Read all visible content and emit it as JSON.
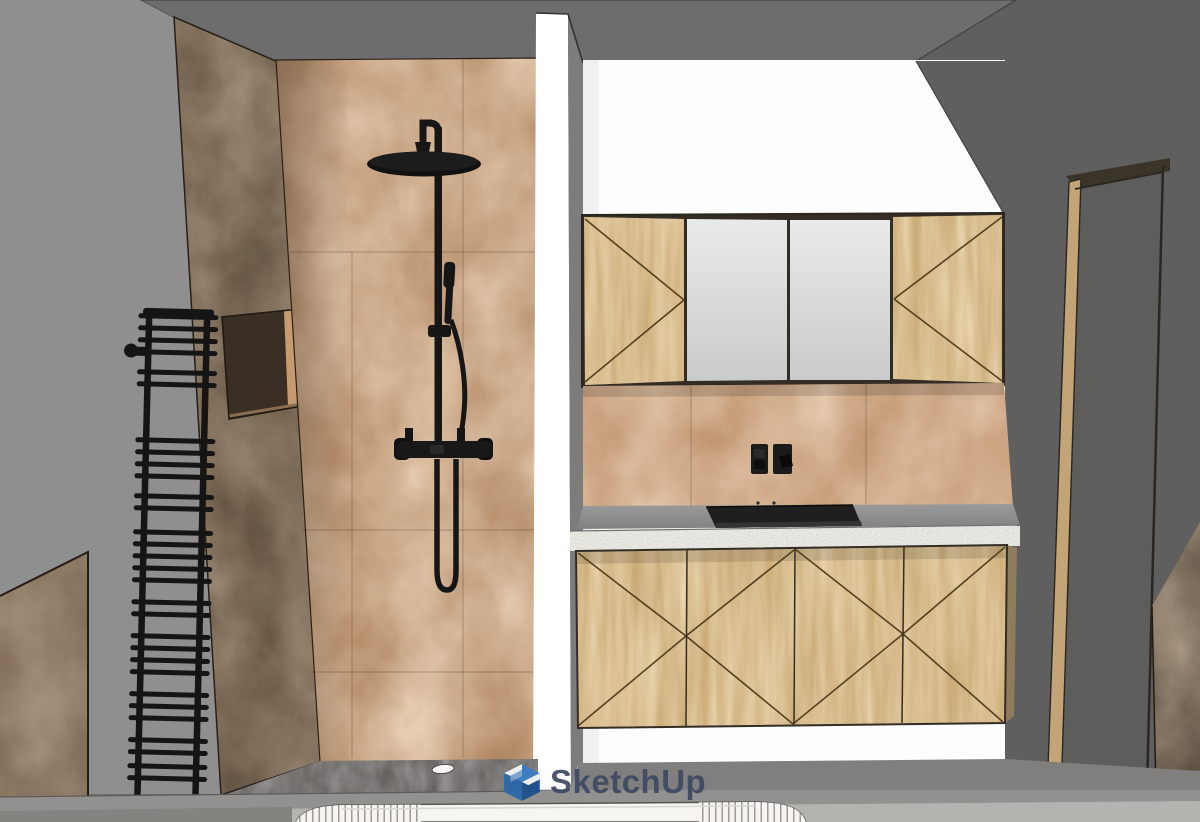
{
  "watermark": {
    "text": "SketchUp",
    "text_color": "#3e4a63",
    "logo_colors": {
      "top": "#3b7fc4",
      "left": "#2a67aa",
      "right": "#1c4e8b",
      "fold": "#ffffff"
    }
  },
  "viewport": {
    "kind": "sketchup-3d-model-view",
    "description": "Bathroom interior: tiled walk-in shower with black rain shower column and black ladder towel radiator on the left; white partition wall; wooden mirror cabinet and 4-door vanity with white-edged countertop, black sink and black double socket on the right; door frame on right wall; fluted freestanding bathtub rim at bottom edge",
    "objects": [
      {
        "name": "ceiling",
        "color": "#6d6d6d"
      },
      {
        "name": "left-wall",
        "color": "#8f8f8f"
      },
      {
        "name": "right-wall",
        "color": "#5f5f5f"
      },
      {
        "name": "white-back-wall",
        "color": "#fdfdfd"
      },
      {
        "name": "partition-wall",
        "face_color": "#ffffff",
        "side_color": "#7c7c7c"
      },
      {
        "name": "shower-side-wall",
        "color": "#51402e"
      },
      {
        "name": "shower-back-wall-tiles",
        "color": "#a87c57"
      },
      {
        "name": "shower-niche",
        "back_color": "#c59b6f"
      },
      {
        "name": "rain-shower-column",
        "color": "#161616"
      },
      {
        "name": "hand-shower-with-hose",
        "color": "#161616"
      },
      {
        "name": "thermostatic-valve",
        "color": "#181818"
      },
      {
        "name": "towel-radiator",
        "color": "#151515",
        "style": "ladder"
      },
      {
        "name": "half-wall-panel",
        "color": "#6d5642"
      },
      {
        "name": "mirror-cabinet",
        "wood_color": "#c6a46d",
        "mirror_color": "#d9dbda",
        "wood_doors": 2,
        "mirror_doors": 2
      },
      {
        "name": "backsplash-tiles",
        "color": "#b5835c"
      },
      {
        "name": "double-socket",
        "color": "#1b1b1b",
        "modules": 2
      },
      {
        "name": "countertop",
        "top_color": "#8f8f8f",
        "edge_color": "#f0efe9"
      },
      {
        "name": "sink",
        "color": "#1f1f1f"
      },
      {
        "name": "vanity-unit",
        "wood_color": "#c6a46d",
        "doors": 4
      },
      {
        "name": "door-frame",
        "jamb_color": "#c2a476",
        "frame_color": "#3b3429"
      },
      {
        "name": "open-door",
        "color": "#4a3e31"
      },
      {
        "name": "shower-floor",
        "color": "#53504d",
        "drain_color": "#f8f7f3"
      },
      {
        "name": "floor",
        "band_color": "#929190"
      },
      {
        "name": "bathtub",
        "color": "#f6f5f1",
        "style": "fluted-ribbed"
      }
    ]
  },
  "theme": {
    "colors": {
      "ceiling": "#6d6d6d",
      "wall-left": "#8f8f8f",
      "wall-right": "#5f5f5f",
      "wall-white": "#fdfdfd",
      "partition-face": "#ffffff",
      "partition-side": "#7c7c7c",
      "tile-base": "#a87c57",
      "tile-backsplash": "#b5835c",
      "dark-wall": "#51402e",
      "panel-brown": "#6d5642",
      "wood": "#c6a46d",
      "wood-line": "#54401f",
      "line-dark": "#2b2621",
      "counter-top": "#8f8f8f",
      "counter-edge": "#f0efe9",
      "sink": "#1f1f1f",
      "black": "#161616",
      "shower-floor": "#53504d",
      "floor-band": "#929190",
      "floor-left": "#84837f",
      "floor-right": "#b4b3af",
      "tub": "#f6f5f1",
      "door-jamb": "#c2a476",
      "door-dark": "#4a3e31",
      "frame-dark": "#3b3429",
      "wm-text": "#3e4a63",
      "logo-top": "#3b7fc4",
      "logo-left": "#2a67aa",
      "logo-right": "#1c4e8b"
    }
  }
}
